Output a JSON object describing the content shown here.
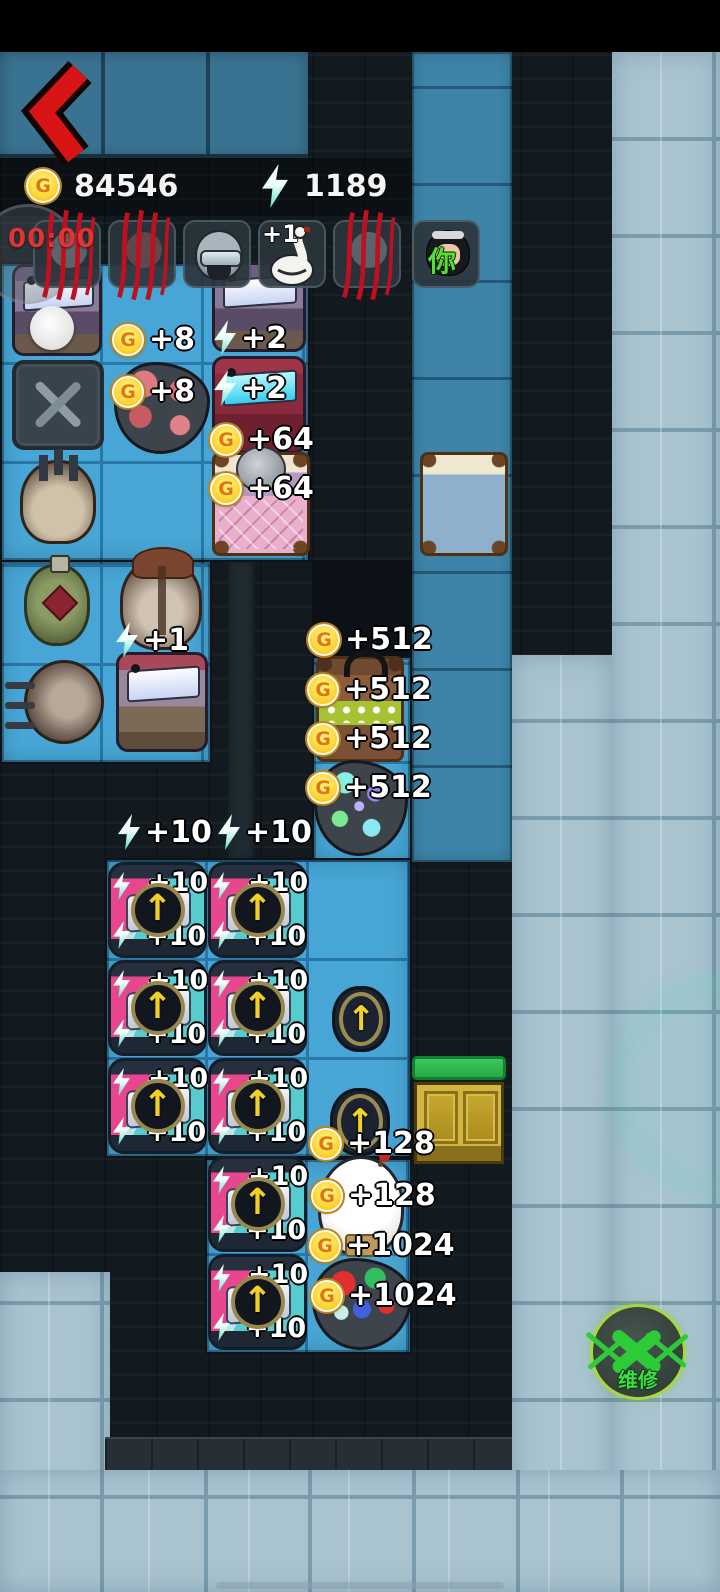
{
  "hud": {
    "coin_value": "84546",
    "energy_value": "1189",
    "timer": "00:00",
    "goose_bonus": "+1",
    "you_label": "你",
    "repair_label": "维修"
  },
  "icons": {
    "coin_letter": "G",
    "upgrade_arrow": "↑",
    "energy": "lightning-bolt",
    "back": "red-chevron-left",
    "repair": "crossed-wrenches"
  },
  "colors": {
    "coin_gold": "#ffc91c",
    "energy_cyan": "#62dcc8",
    "tile_blue": "#47a6d5",
    "frost_tile": "#a9c3cf",
    "repair_green": "#2ecb38",
    "hp_green": "#2db84e",
    "back_red": "#d81414",
    "timer_red": "#e03434"
  },
  "board": {
    "rewards": [
      {
        "k": "coin",
        "v": "+8",
        "x": 112,
        "y": 322
      },
      {
        "k": "coin",
        "v": "+8",
        "x": 112,
        "y": 374
      },
      {
        "k": "bolt",
        "v": "+2",
        "x": 214,
        "y": 320
      },
      {
        "k": "bolt",
        "v": "+2",
        "x": 214,
        "y": 370
      },
      {
        "k": "coin",
        "v": "+64",
        "x": 210,
        "y": 422
      },
      {
        "k": "coin",
        "v": "+64",
        "x": 210,
        "y": 471
      },
      {
        "k": "bolt",
        "v": "+1",
        "x": 116,
        "y": 622
      },
      {
        "k": "coin",
        "v": "+512",
        "x": 308,
        "y": 622
      },
      {
        "k": "coin",
        "v": "+512",
        "x": 307,
        "y": 672
      },
      {
        "k": "coin",
        "v": "+512",
        "x": 307,
        "y": 721
      },
      {
        "k": "coin",
        "v": "+512",
        "x": 307,
        "y": 770
      },
      {
        "k": "bolt",
        "v": "+10",
        "x": 118,
        "y": 814
      },
      {
        "k": "bolt",
        "v": "+10",
        "x": 218,
        "y": 814
      },
      {
        "k": "coin",
        "v": "+128",
        "x": 310,
        "y": 1126
      },
      {
        "k": "coin",
        "v": "+128",
        "x": 311,
        "y": 1178
      },
      {
        "k": "coin",
        "v": "+1024",
        "x": 309,
        "y": 1228
      },
      {
        "k": "coin",
        "v": "+1024",
        "x": 311,
        "y": 1278
      }
    ],
    "chests": [
      {
        "x": 108,
        "y": 862,
        "top": "+10",
        "bottom": "+10"
      },
      {
        "x": 208,
        "y": 862,
        "top": "+10",
        "bottom": "+10"
      },
      {
        "x": 108,
        "y": 960,
        "top": "+10",
        "bottom": "+10"
      },
      {
        "x": 208,
        "y": 960,
        "top": "+10",
        "bottom": "+10"
      },
      {
        "x": 108,
        "y": 1058,
        "top": "+10",
        "bottom": "+10"
      },
      {
        "x": 208,
        "y": 1058,
        "top": "+10",
        "bottom": "+10"
      },
      {
        "x": 208,
        "y": 1156,
        "top": "+10",
        "bottom": "+10"
      },
      {
        "x": 208,
        "y": 1254,
        "top": "+10",
        "bottom": "+10"
      }
    ],
    "objects": [
      {
        "cls": "sp-arcade",
        "x": 12,
        "y": 264,
        "w": 90,
        "h": 92,
        "name": "arcade-machine"
      },
      {
        "cls": "sp-white-circle",
        "x": 30,
        "y": 306,
        "w": 44,
        "h": 44,
        "name": "white-token"
      },
      {
        "cls": "sp-arcade",
        "x": 212,
        "y": 262,
        "w": 94,
        "h": 90,
        "name": "arcade-machine"
      },
      {
        "cls": "sp-toolbox",
        "x": 12,
        "y": 360,
        "w": 92,
        "h": 90,
        "name": "toolbox"
      },
      {
        "cls": "sp-rock r-meat",
        "x": 114,
        "y": 362,
        "w": 96,
        "h": 92,
        "name": "ore-rock"
      },
      {
        "cls": "sp-arcade v-red",
        "x": 212,
        "y": 356,
        "w": 94,
        "h": 98,
        "name": "arcade-machine-red"
      },
      {
        "cls": "sp-helmet",
        "x": 20,
        "y": 460,
        "w": 76,
        "h": 84,
        "name": "helmet"
      },
      {
        "cls": "sp-bed b-pink",
        "x": 212,
        "y": 452,
        "w": 98,
        "h": 104,
        "name": "bed-pink"
      },
      {
        "cls": "sp-ball-gray",
        "x": 236,
        "y": 446,
        "w": 50,
        "h": 46,
        "name": "sleeping-character"
      },
      {
        "cls": "sp-bed b-blue",
        "x": 420,
        "y": 452,
        "w": 88,
        "h": 104,
        "name": "bed-blue"
      },
      {
        "cls": "sp-potion",
        "x": 24,
        "y": 564,
        "w": 66,
        "h": 82,
        "name": "potion"
      },
      {
        "cls": "sp-sack",
        "x": 120,
        "y": 558,
        "w": 82,
        "h": 92,
        "name": "sack"
      },
      {
        "cls": "sp-mine",
        "x": 24,
        "y": 660,
        "w": 80,
        "h": 84,
        "name": "mine"
      },
      {
        "cls": "sp-arcade v-redtop",
        "x": 116,
        "y": 652,
        "w": 92,
        "h": 100,
        "name": "arcade-machine-redtop"
      },
      {
        "cls": "sp-bed b-green",
        "x": 316,
        "y": 656,
        "w": 88,
        "h": 106,
        "name": "bed-occupied"
      },
      {
        "cls": "sp-rock r-gem",
        "x": 314,
        "y": 760,
        "w": 94,
        "h": 96,
        "name": "gem-rock"
      },
      {
        "cls": "sp-token",
        "x": 332,
        "y": 986,
        "w": 58,
        "h": 66,
        "name": "upgrade-token",
        "g": true
      },
      {
        "cls": "sp-token",
        "x": 330,
        "y": 1088,
        "w": 60,
        "h": 68,
        "name": "upgrade-token",
        "g": true
      },
      {
        "cls": "sp-door-bar",
        "x": 412,
        "y": 1056,
        "w": 94,
        "h": 24,
        "name": "door-health-bar"
      },
      {
        "cls": "sp-door",
        "x": 414,
        "y": 1082,
        "w": 90,
        "h": 82,
        "name": "door"
      },
      {
        "cls": "sp-icecream",
        "x": 318,
        "y": 1156,
        "w": 86,
        "h": 100,
        "name": "ice-cream"
      },
      {
        "cls": "sp-rock r-rgb",
        "x": 312,
        "y": 1258,
        "w": 100,
        "h": 92,
        "name": "gem-rock"
      }
    ]
  }
}
